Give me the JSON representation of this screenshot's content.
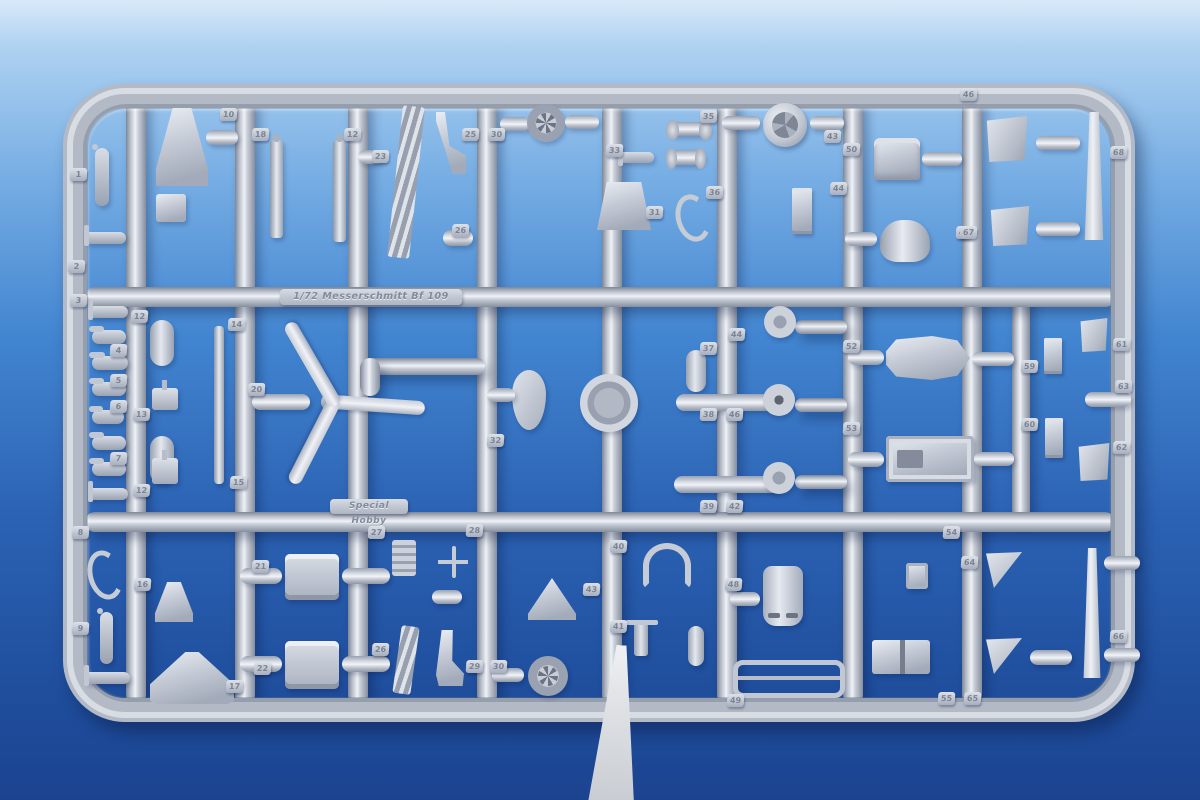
{
  "plates": {
    "kit": "1/72 Messerschmitt Bf 109",
    "brand": "Special Hobby"
  },
  "colors": {
    "bg0": "#d9e9f8",
    "bg1": "#aed1f1",
    "bg2": "#77aee4",
    "bg3": "#4285d0",
    "bg4": "#2c63b4",
    "bg5": "#20509f",
    "bg6": "#1b4390",
    "plastic": "#b3bac6",
    "plastic_highlight": "#eff2f6",
    "plastic_shadow": "#7e8695",
    "part_styrene": "#ccd2dc",
    "tag_text": "#7b8494",
    "white_strip": "#eef0f3"
  },
  "sprue": {
    "frame": {
      "x": 63,
      "y": 84,
      "w": 1072,
      "h": 638
    },
    "runners": [
      {
        "o": "v",
        "x": 126,
        "y": 95,
        "w": 20,
        "h": 610
      },
      {
        "o": "v",
        "x": 235,
        "y": 95,
        "w": 20,
        "h": 610
      },
      {
        "o": "v",
        "x": 348,
        "y": 95,
        "w": 20,
        "h": 610
      },
      {
        "o": "v",
        "x": 477,
        "y": 95,
        "w": 20,
        "h": 610
      },
      {
        "o": "v",
        "x": 602,
        "y": 95,
        "w": 20,
        "h": 610
      },
      {
        "o": "v",
        "x": 717,
        "y": 95,
        "w": 20,
        "h": 610
      },
      {
        "o": "v",
        "x": 843,
        "y": 95,
        "w": 20,
        "h": 610
      },
      {
        "o": "v",
        "x": 962,
        "y": 95,
        "w": 20,
        "h": 610
      },
      {
        "o": "v",
        "x": 1012,
        "y": 288,
        "w": 18,
        "h": 232
      },
      {
        "o": "h",
        "x": 85,
        "y": 287,
        "w": 1030,
        "h": 20
      },
      {
        "o": "h",
        "x": 85,
        "y": 512,
        "w": 1030,
        "h": 20
      },
      {
        "o": "h",
        "x": 365,
        "y": 358,
        "w": 120,
        "h": 17
      },
      {
        "o": "v",
        "x": 360,
        "y": 358,
        "w": 20,
        "h": 38
      },
      {
        "o": "h",
        "x": 795,
        "y": 320,
        "w": 52,
        "h": 14
      },
      {
        "o": "h",
        "x": 795,
        "y": 398,
        "w": 52,
        "h": 14
      },
      {
        "o": "h",
        "x": 795,
        "y": 475,
        "w": 52,
        "h": 14
      }
    ]
  },
  "parts": [
    {
      "shape": "lever",
      "x": 95,
      "y": 148,
      "w": 14,
      "h": 58,
      "num": "1",
      "tx": 70,
      "ty": 168
    },
    {
      "shape": "tlever",
      "x": 84,
      "y": 232,
      "w": 42,
      "h": 12,
      "num": "2",
      "tx": 68,
      "ty": 260
    },
    {
      "shape": "funnel",
      "x": 156,
      "y": 108,
      "w": 52,
      "h": 78,
      "num": "10",
      "tx": 220,
      "ty": 108
    },
    {
      "shape": "capsule",
      "x": 206,
      "y": 130,
      "w": 32,
      "h": 15
    },
    {
      "shape": "box",
      "x": 156,
      "y": 194,
      "w": 30,
      "h": 28
    },
    {
      "shape": "rod",
      "x": 270,
      "y": 140,
      "w": 13,
      "h": 98,
      "num": "18",
      "tx": 252,
      "ty": 128
    },
    {
      "shape": "rod",
      "x": 333,
      "y": 140,
      "w": 13,
      "h": 102,
      "num": "12",
      "tx": 344,
      "ty": 128
    },
    {
      "shape": "capsule",
      "x": 358,
      "y": 150,
      "w": 26,
      "h": 14,
      "num": "23",
      "tx": 372,
      "ty": 150
    },
    {
      "shape": "ladder",
      "x": 395,
      "y": 106,
      "w": 22,
      "h": 152,
      "rot": 6
    },
    {
      "shape": "sling",
      "x": 436,
      "y": 112,
      "w": 30,
      "h": 62,
      "num": "25",
      "tx": 462,
      "ty": 128
    },
    {
      "shape": "capsule",
      "x": 500,
      "y": 117,
      "w": 30,
      "h": 14,
      "num": "30",
      "tx": 488,
      "ty": 128
    },
    {
      "shape": "wheel",
      "x": 527,
      "y": 104,
      "w": 38,
      "h": 38
    },
    {
      "shape": "capsule",
      "x": 565,
      "y": 115,
      "w": 34,
      "h": 14
    },
    {
      "shape": "tlever",
      "x": 618,
      "y": 152,
      "w": 36,
      "h": 11,
      "num": "33",
      "tx": 606,
      "ty": 144
    },
    {
      "shape": "seat",
      "x": 597,
      "y": 182,
      "w": 54,
      "h": 48,
      "num": "31",
      "tx": 646,
      "ty": 206
    },
    {
      "shape": "capsule",
      "x": 443,
      "y": 230,
      "w": 30,
      "h": 16,
      "num": "26",
      "tx": 452,
      "ty": 224
    },
    {
      "shape": "dumbbell",
      "x": 668,
      "y": 122,
      "w": 42,
      "h": 14,
      "num": "35",
      "tx": 700,
      "ty": 110
    },
    {
      "shape": "dumbbell",
      "x": 668,
      "y": 150,
      "w": 36,
      "h": 15
    },
    {
      "shape": "hook",
      "x": 676,
      "y": 194,
      "w": 24,
      "h": 38,
      "num": "36",
      "tx": 706,
      "ty": 186
    },
    {
      "shape": "disc",
      "x": 763,
      "y": 103,
      "w": 44,
      "h": 44,
      "num": "43",
      "tx": 824,
      "ty": 130
    },
    {
      "shape": "capsule",
      "x": 722,
      "y": 116,
      "w": 38,
      "h": 14
    },
    {
      "shape": "capsule",
      "x": 810,
      "y": 116,
      "w": 34,
      "h": 14
    },
    {
      "shape": "seat2",
      "x": 874,
      "y": 138,
      "w": 46,
      "h": 42,
      "num": "50",
      "tx": 843,
      "ty": 143
    },
    {
      "shape": "capsule",
      "x": 922,
      "y": 152,
      "w": 40,
      "h": 14
    },
    {
      "shape": "bracket",
      "x": 792,
      "y": 188,
      "w": 20,
      "h": 46,
      "num": "44",
      "tx": 830,
      "ty": 182
    },
    {
      "shape": "cowl",
      "x": 880,
      "y": 220,
      "w": 50,
      "h": 42,
      "num": "47",
      "tx": 956,
      "ty": 226
    },
    {
      "shape": "capsule",
      "x": 845,
      "y": 232,
      "w": 32,
      "h": 14
    },
    {
      "shape": "panel",
      "x": 986,
      "y": 116,
      "w": 42,
      "h": 46,
      "num": "46",
      "tx": 960,
      "ty": 88
    },
    {
      "shape": "panel",
      "x": 990,
      "y": 206,
      "w": 40,
      "h": 40,
      "num": "67",
      "tx": 960,
      "ty": 226
    },
    {
      "shape": "vblade",
      "x": 1083,
      "y": 112,
      "w": 22,
      "h": 128,
      "num": "68",
      "tx": 1110,
      "ty": 146
    },
    {
      "shape": "capsule",
      "x": 1036,
      "y": 136,
      "w": 44,
      "h": 14
    },
    {
      "shape": "capsule",
      "x": 1036,
      "y": 222,
      "w": 44,
      "h": 14
    },
    {
      "shape": "tlever",
      "x": 88,
      "y": 306,
      "w": 40,
      "h": 12,
      "num": "3",
      "tx": 70,
      "ty": 294
    },
    {
      "shape": "lever",
      "x": 92,
      "y": 330,
      "w": 34,
      "h": 14,
      "num": "4",
      "tx": 110,
      "ty": 344
    },
    {
      "shape": "lever",
      "x": 92,
      "y": 356,
      "w": 36,
      "h": 14,
      "num": "5",
      "tx": 110,
      "ty": 374
    },
    {
      "shape": "lever",
      "x": 92,
      "y": 382,
      "w": 34,
      "h": 14,
      "num": "6",
      "tx": 110,
      "ty": 400
    },
    {
      "shape": "lever",
      "x": 92,
      "y": 410,
      "w": 32,
      "h": 14,
      "num": "7",
      "tx": 110,
      "ty": 452
    },
    {
      "shape": "lever",
      "x": 92,
      "y": 436,
      "w": 34,
      "h": 14
    },
    {
      "shape": "lever",
      "x": 92,
      "y": 462,
      "w": 34,
      "h": 14
    },
    {
      "shape": "tlever",
      "x": 88,
      "y": 488,
      "w": 40,
      "h": 12
    },
    {
      "shape": "vcapsule",
      "x": 150,
      "y": 320,
      "w": 24,
      "h": 46,
      "num": "12",
      "tx": 131,
      "ty": 310
    },
    {
      "shape": "pedal",
      "x": 152,
      "y": 388,
      "w": 26,
      "h": 22
    },
    {
      "shape": "vcapsule",
      "x": 150,
      "y": 436,
      "w": 24,
      "h": 48,
      "num": "13",
      "tx": 133,
      "ty": 408
    },
    {
      "shape": "pedal",
      "x": 152,
      "y": 458,
      "w": 26,
      "h": 26,
      "num": "12",
      "tx": 133,
      "ty": 484
    },
    {
      "shape": "rodthin",
      "x": 214,
      "y": 326,
      "w": 10,
      "h": 158,
      "num": "14",
      "tx": 228,
      "ty": 318
    },
    {
      "shape": "hub",
      "x": 321,
      "y": 393,
      "w": 18,
      "h": 18,
      "num": "20",
      "tx": 248,
      "ty": 383
    },
    {
      "shape": "pblade",
      "x": 330,
      "y": 395,
      "w": 95,
      "h": 14,
      "rot": 4
    },
    {
      "shape": "pblade",
      "x": 330,
      "y": 395,
      "w": 95,
      "h": 14,
      "rot": 117
    },
    {
      "shape": "pblade",
      "x": 330,
      "y": 395,
      "w": 95,
      "h": 14,
      "rot": 240
    },
    {
      "shape": "capsule",
      "x": 252,
      "y": 394,
      "w": 58,
      "h": 16
    },
    {
      "shape": "drop",
      "x": 512,
      "y": 370,
      "w": 34,
      "h": 60,
      "num": "32",
      "tx": 487,
      "ty": 434
    },
    {
      "shape": "capsule",
      "x": 487,
      "y": 388,
      "w": 28,
      "h": 14
    },
    {
      "shape": "ring",
      "x": 580,
      "y": 374,
      "w": 58,
      "h": 58
    },
    {
      "shape": "vcapsule",
      "x": 686,
      "y": 350,
      "w": 20,
      "h": 42,
      "num": "37",
      "tx": 700,
      "ty": 342
    },
    {
      "shape": "bomb",
      "x": 676,
      "y": 394,
      "w": 104,
      "h": 17,
      "num": "38",
      "tx": 700,
      "ty": 408
    },
    {
      "shape": "bomb",
      "x": 674,
      "y": 476,
      "w": 106,
      "h": 17,
      "num": "39",
      "tx": 700,
      "ty": 500
    },
    {
      "shape": "star",
      "x": 764,
      "y": 306,
      "w": 32,
      "h": 32
    },
    {
      "shape": "starring",
      "x": 763,
      "y": 384,
      "w": 32,
      "h": 32
    },
    {
      "shape": "star",
      "x": 763,
      "y": 462,
      "w": 32,
      "h": 32
    },
    {
      "shape": "boat",
      "x": 886,
      "y": 336,
      "w": 84,
      "h": 44,
      "num": "52",
      "tx": 843,
      "ty": 340
    },
    {
      "shape": "capsule",
      "x": 848,
      "y": 350,
      "w": 36,
      "h": 15
    },
    {
      "shape": "capsule",
      "x": 972,
      "y": 352,
      "w": 42,
      "h": 14
    },
    {
      "shape": "gearbox",
      "x": 886,
      "y": 436,
      "w": 88,
      "h": 46,
      "num": "53",
      "tx": 843,
      "ty": 422
    },
    {
      "shape": "capsule",
      "x": 848,
      "y": 452,
      "w": 36,
      "h": 15
    },
    {
      "shape": "capsule",
      "x": 974,
      "y": 452,
      "w": 40,
      "h": 14
    },
    {
      "shape": "bracket",
      "x": 1044,
      "y": 338,
      "w": 18,
      "h": 36,
      "num": "59",
      "tx": 1021,
      "ty": 360
    },
    {
      "shape": "bracket",
      "x": 1045,
      "y": 418,
      "w": 18,
      "h": 40,
      "num": "60",
      "tx": 1021,
      "ty": 418
    },
    {
      "shape": "panel",
      "x": 1080,
      "y": 318,
      "w": 28,
      "h": 34,
      "num": "61",
      "tx": 1113,
      "ty": 338
    },
    {
      "shape": "capsule",
      "x": 1085,
      "y": 392,
      "w": 46,
      "h": 15,
      "num": "63",
      "tx": 1115,
      "ty": 380
    },
    {
      "shape": "panel",
      "x": 1078,
      "y": 443,
      "w": 32,
      "h": 38,
      "num": "62",
      "tx": 1113,
      "ty": 441
    },
    {
      "shape": "hook",
      "x": 88,
      "y": 550,
      "w": 24,
      "h": 40,
      "num": "8",
      "tx": 72,
      "ty": 526
    },
    {
      "shape": "lever",
      "x": 100,
      "y": 612,
      "w": 13,
      "h": 52,
      "num": "9",
      "tx": 72,
      "ty": 622
    },
    {
      "shape": "tlever",
      "x": 84,
      "y": 672,
      "w": 46,
      "h": 12
    },
    {
      "shape": "funnel",
      "x": 155,
      "y": 582,
      "w": 38,
      "h": 40,
      "num": "16",
      "tx": 134,
      "ty": 578
    },
    {
      "shape": "trumpet",
      "x": 150,
      "y": 652,
      "w": 84,
      "h": 52,
      "num": "17",
      "tx": 226,
      "ty": 680
    },
    {
      "shape": "radiator",
      "x": 285,
      "y": 554,
      "w": 54,
      "h": 46,
      "num": "21",
      "tx": 252,
      "ty": 560
    },
    {
      "shape": "capsule",
      "x": 240,
      "y": 568,
      "w": 42,
      "h": 16
    },
    {
      "shape": "capsule",
      "x": 342,
      "y": 568,
      "w": 48,
      "h": 16
    },
    {
      "shape": "radiator",
      "x": 285,
      "y": 641,
      "w": 54,
      "h": 48,
      "num": "22",
      "tx": 254,
      "ty": 662
    },
    {
      "shape": "capsule",
      "x": 240,
      "y": 656,
      "w": 42,
      "h": 16
    },
    {
      "shape": "capsule",
      "x": 342,
      "y": 656,
      "w": 48,
      "h": 16
    },
    {
      "shape": "stack",
      "x": 392,
      "y": 540,
      "w": 24,
      "h": 36,
      "num": "27",
      "tx": 368,
      "ty": 526
    },
    {
      "shape": "cross",
      "x": 438,
      "y": 546,
      "w": 30,
      "h": 32,
      "num": "28",
      "tx": 466,
      "ty": 524
    },
    {
      "shape": "ladder",
      "x": 397,
      "y": 626,
      "w": 18,
      "h": 68,
      "rot": 8,
      "num": "26",
      "tx": 372,
      "ty": 643
    },
    {
      "shape": "boot",
      "x": 436,
      "y": 630,
      "w": 28,
      "h": 56,
      "num": "29",
      "tx": 466,
      "ty": 660
    },
    {
      "shape": "capsule",
      "x": 492,
      "y": 668,
      "w": 32,
      "h": 14,
      "num": "30",
      "tx": 490,
      "ty": 660
    },
    {
      "shape": "wheel",
      "x": 528,
      "y": 656,
      "w": 40,
      "h": 40
    },
    {
      "shape": "aframe",
      "x": 528,
      "y": 578,
      "w": 48,
      "h": 42,
      "num": "43",
      "tx": 583,
      "ty": 583
    },
    {
      "shape": "capsule",
      "x": 432,
      "y": 590,
      "w": 30,
      "h": 14
    },
    {
      "shape": "magnet",
      "x": 643,
      "y": 543,
      "w": 36,
      "h": 34,
      "num": "40",
      "tx": 610,
      "ty": 540
    },
    {
      "shape": "tbar",
      "x": 634,
      "y": 620,
      "w": 14,
      "h": 36,
      "num": "41",
      "tx": 610,
      "ty": 620
    },
    {
      "shape": "vcapsule",
      "x": 688,
      "y": 626,
      "w": 16,
      "h": 40
    },
    {
      "shape": "cowlslot",
      "x": 763,
      "y": 566,
      "w": 40,
      "h": 60,
      "num": "48",
      "tx": 725,
      "ty": 578
    },
    {
      "shape": "capsule",
      "x": 730,
      "y": 592,
      "w": 30,
      "h": 14
    },
    {
      "shape": "hframe",
      "x": 733,
      "y": 660,
      "w": 102,
      "h": 28,
      "num": "49",
      "tx": 727,
      "ty": 694
    },
    {
      "shape": "tv",
      "x": 906,
      "y": 563,
      "w": 22,
      "h": 26,
      "num": "64",
      "tx": 961,
      "ty": 556
    },
    {
      "shape": "tri",
      "x": 986,
      "y": 552,
      "w": 36,
      "h": 36,
      "num": "54",
      "tx": 943,
      "ty": 526
    },
    {
      "shape": "boxpair",
      "x": 872,
      "y": 640,
      "w": 58,
      "h": 34,
      "num": "55",
      "tx": 938,
      "ty": 692
    },
    {
      "shape": "tri",
      "x": 986,
      "y": 638,
      "w": 36,
      "h": 36,
      "num": "65",
      "tx": 964,
      "ty": 692
    },
    {
      "shape": "capsule",
      "x": 1030,
      "y": 650,
      "w": 42,
      "h": 15
    },
    {
      "shape": "vblade",
      "x": 1082,
      "y": 548,
      "w": 20,
      "h": 130,
      "num": "66",
      "tx": 1110,
      "ty": 630
    },
    {
      "shape": "capsule",
      "x": 1104,
      "y": 556,
      "w": 36,
      "h": 14
    },
    {
      "shape": "capsule",
      "x": 1104,
      "y": 648,
      "w": 36,
      "h": 14
    }
  ],
  "extra_tags": [
    {
      "n": "15",
      "x": 230,
      "y": 476
    },
    {
      "n": "46",
      "x": 726,
      "y": 408
    },
    {
      "n": "42",
      "x": 726,
      "y": 500
    },
    {
      "n": "44",
      "x": 728,
      "y": 328
    }
  ],
  "white_strip": {
    "x": 585,
    "y": 645,
    "w": 62,
    "h": 158,
    "rot": 4
  }
}
